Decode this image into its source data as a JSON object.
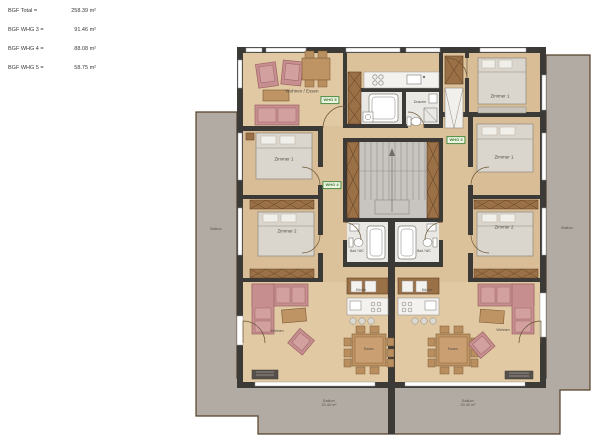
{
  "legend": {
    "rows": [
      {
        "label": "BGF Total =",
        "value": "258.39 m²"
      },
      {
        "label": "BGF WHG 3 =",
        "value": "91.46 m²"
      },
      {
        "label": "BGF WHG 4 =",
        "value": "88.08 m²"
      },
      {
        "label": "BGF WHG 5 =",
        "value": "58.75 m²"
      }
    ]
  },
  "plan": {
    "units": {
      "whg3": "WHG 3",
      "whg4": "WHG 4",
      "whg5": "WHG 5"
    },
    "rooms": {
      "wohnen_essen": "Wohnen / Essen",
      "zimmer1": "Zimmer 1",
      "zimmer2": "Zimmer 2",
      "dusche": "Dusche",
      "bad_wc": "Bad / WC",
      "kueche": "Küche",
      "essen": "Essen",
      "wohnen": "Wohnen",
      "balkon": "Balkon",
      "balkon_area": "20.40 m²"
    },
    "colors": {
      "wall": "#3c3a37",
      "floor_wood": "#dcc29b",
      "floor_living": "#e1c9a3",
      "floor_bedroom": "#d8bd96",
      "balcony": "#b2aba4",
      "bath": "#eae8e4",
      "sofa": "#c68e8e",
      "furniture_wood": "#bf9464",
      "wardrobe": "#9a7047",
      "unit_label": "#3f7d31",
      "stairs": "#c8c5c0"
    }
  }
}
